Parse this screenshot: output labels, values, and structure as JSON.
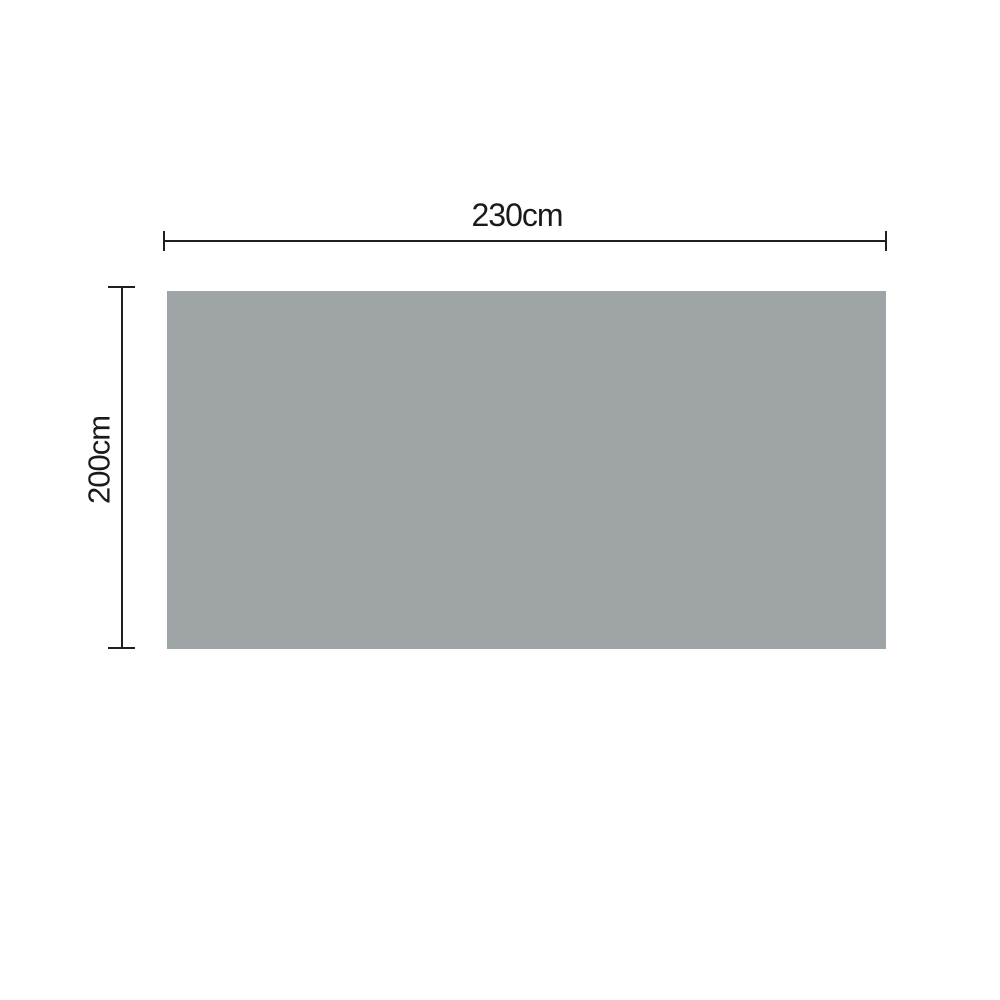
{
  "page": {
    "background_color": "#ffffff"
  },
  "diagram": {
    "rectangle": {
      "fill_color": "#9fa4a6"
    },
    "line_color": "#1f1f1f",
    "text_color": "#1a1a1a",
    "width_dimension": {
      "label": "230cm"
    },
    "height_dimension": {
      "label": "200cm"
    }
  }
}
